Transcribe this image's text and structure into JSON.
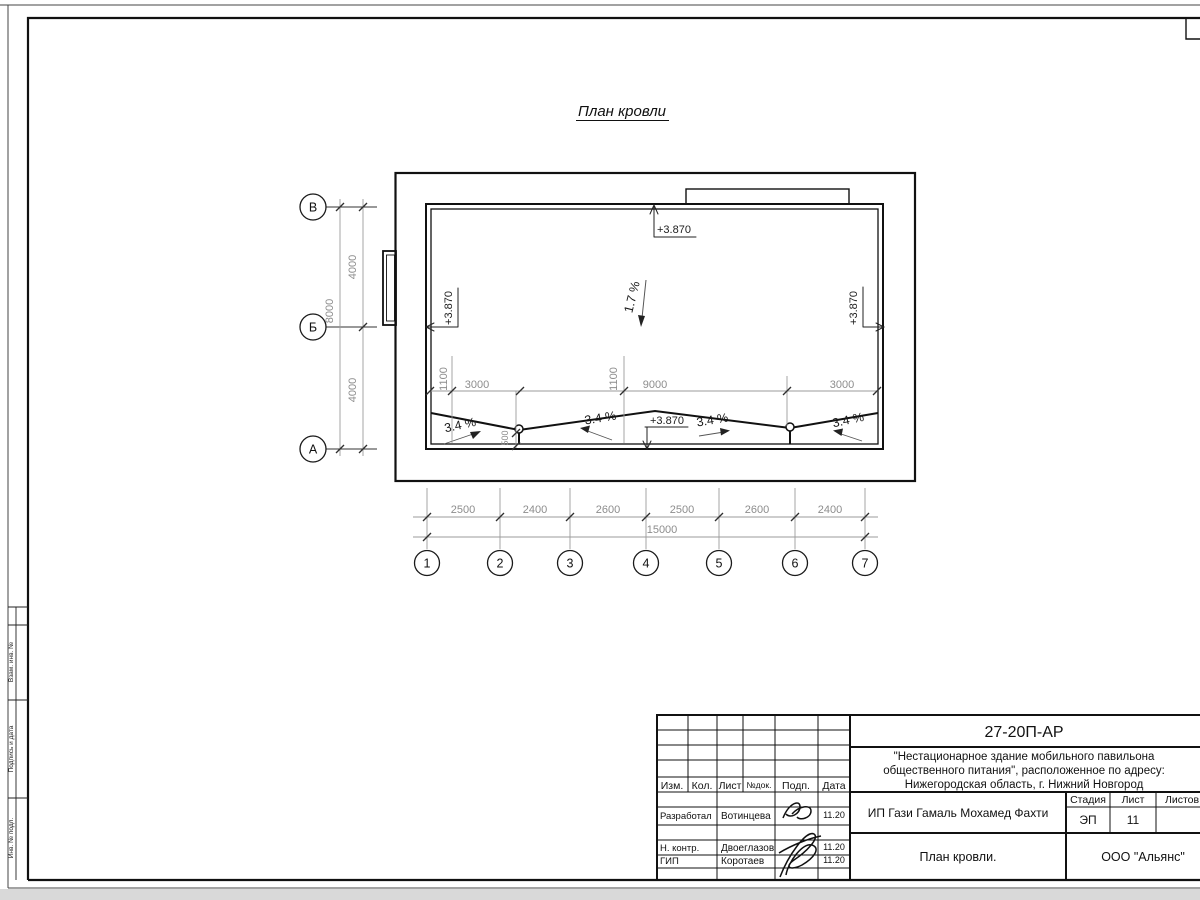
{
  "d": {
    "title": "План кровли",
    "elev": "+3.870",
    "slope_main": "1.7 %",
    "slope_cross": "3.4 %",
    "dim_4000": "4000",
    "dim_8000": "8000",
    "dim_1100": "1100",
    "dim_500": "500",
    "dim_3000": "3000",
    "dim_9000": "9000",
    "dims_bottom": [
      "2500",
      "2400",
      "2600",
      "2500",
      "2600",
      "2400"
    ],
    "dim_total": "15000",
    "axis_rows": [
      "В",
      "Б",
      "А"
    ],
    "axis_cols": [
      "1",
      "2",
      "3",
      "4",
      "5",
      "6",
      "7"
    ]
  },
  "stamp": {
    "cells": [
      "Взам. инв. №",
      "Подпись и дата",
      "Инв. № подл."
    ]
  },
  "tb": {
    "doc": "27-20П-АР",
    "proj1": "\"Нестационарное здание мобильного павильона",
    "proj2": "общественного питания\", расположенное по адресу:",
    "proj3": "Нижегородская область, г. Нижний Новгород",
    "client": "ИП Гази Гамаль Мохамед Фахти",
    "name": "План кровли.",
    "company": "ООО \"Альянс\"",
    "stadia": "Стадия",
    "list": "Лист",
    "listov": "Листов",
    "stadia_v": "ЭП",
    "list_v": "11",
    "h": [
      "Изм.",
      "Кол.",
      "Лист",
      "№док.",
      "Подп.",
      "Дата"
    ],
    "r1": {
      "role": "Разработал",
      "name": "Вотинцева",
      "date": "11.20"
    },
    "r2": {
      "role": "Н. контр.",
      "name": "Двоеглазов",
      "date": "11.20"
    },
    "r3": {
      "role": "ГИП",
      "name": "Коротаев",
      "date": "11.20"
    }
  }
}
